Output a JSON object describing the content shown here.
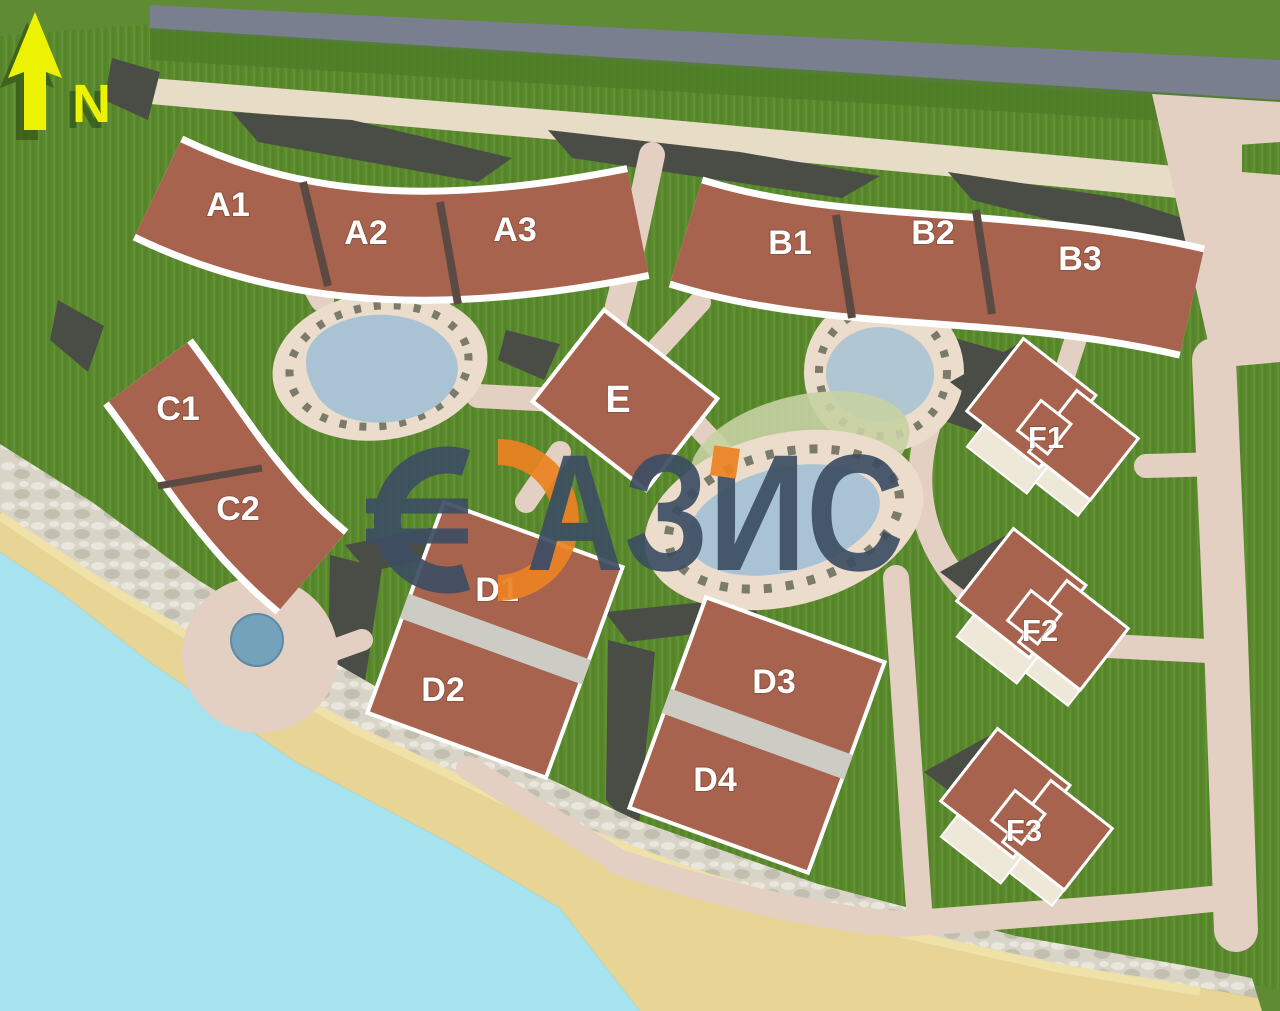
{
  "compass": {
    "label": "N",
    "color": "#edf202",
    "shadow": "#2f4f14"
  },
  "watermark": {
    "symbol": "€",
    "text": "АЗИС",
    "brand": "ОАЗИС",
    "navy": "#3d4e63",
    "orange": "#ec8222"
  },
  "buildings": [
    {
      "label": "A1"
    },
    {
      "label": "A2"
    },
    {
      "label": "A3"
    },
    {
      "label": "B1"
    },
    {
      "label": "B2"
    },
    {
      "label": "B3"
    },
    {
      "label": "C1"
    },
    {
      "label": "C2"
    },
    {
      "label": "E"
    },
    {
      "label": "D1"
    },
    {
      "label": "D2"
    },
    {
      "label": "D3"
    },
    {
      "label": "D4"
    },
    {
      "label": "F1"
    },
    {
      "label": "F2"
    },
    {
      "label": "F3"
    }
  ],
  "palette": {
    "background_green": "#5e8b33",
    "grass_base": "#5b8a2e",
    "grass_dark": "#5280256",
    "grass_line_dark": "#528025",
    "grass_line_light": "#67973a",
    "hedge_green": "#4e7d27",
    "road_gray": "#797f8e",
    "path_pink": "#e4d0c2",
    "plaza_cream": "#e7dcc6",
    "dark_structure": "#4a4d46",
    "roof": "#a8634e",
    "roof_gap": "#5b4a44",
    "divider": "#cdccc4",
    "deck": "#ecdccb",
    "terrace": "#eee8d8",
    "pool_blue": "#aac3d4",
    "pool_small": "#74a2ba",
    "sage": "#c6d0a2",
    "lounger": "#5f6352",
    "sea": "#a6e3ef",
    "sand": "#e8d494",
    "sand_highlight": "#f2e6ae",
    "rock_base": "#d8d4c7",
    "rock_light": "#e9e7dd",
    "rock_dark": "#c3bfb0",
    "label_white": "#ffffff"
  }
}
